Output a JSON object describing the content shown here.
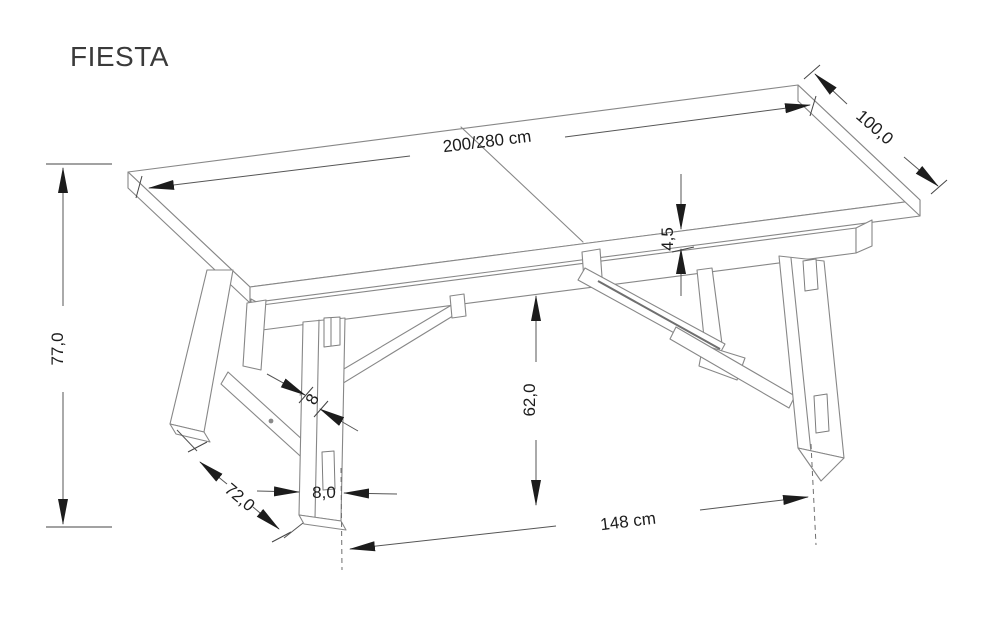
{
  "title": "FIESTA",
  "colors": {
    "background": "#ffffff",
    "drawing_line": "#878787",
    "dimension_line": "#555555",
    "dimension_text": "#1c1c1c"
  },
  "dimensions": {
    "length": "200/280 cm",
    "depth": "100,0",
    "top_thickness": "4,5",
    "total_height": "77,0",
    "underframe_height": "62,0",
    "leg_span": "148 cm",
    "trestle_depth": "72,0",
    "leg_width": "8,0",
    "brace_thickness": "8"
  }
}
